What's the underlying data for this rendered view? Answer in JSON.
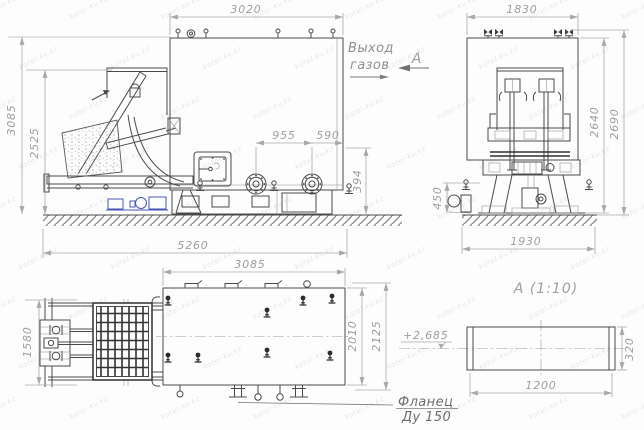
{
  "watermark": {
    "text": "kotel-kv.kz"
  },
  "colors": {
    "object_line": "#4a4a4a",
    "dim_line": "#a8a8a8",
    "dim_text": "#9e9e9e",
    "accent_blue": "#4656b8",
    "hatch": "#9a9a9a"
  },
  "side_view": {
    "dims": {
      "furnace_width": "3020",
      "overall_height": "3085",
      "loader_height": "2525",
      "flange_spacing": "955",
      "flange_to_wall": "590",
      "base_height": "394",
      "overall_length": "5260"
    },
    "gas_outlet_label_line1": "Выход",
    "gas_outlet_label_line2": "газов",
    "section_letter": "А"
  },
  "front_view": {
    "dims": {
      "body_width": "1830",
      "body_height": "2640",
      "overall_height": "2690",
      "base_height": "450",
      "base_width": "1930"
    }
  },
  "plan_view": {
    "dims": {
      "body_length": "3085",
      "loader_width": "1580",
      "body_depth": "2010",
      "overall_depth": "2125"
    }
  },
  "detail_view": {
    "title": "А  (1:10)",
    "dims": {
      "flange_length": "1200",
      "flange_height": "320"
    },
    "elevation_mark": "+2,685",
    "flange_callout_line1": "Фланец",
    "flange_callout_line2": "Ду 150"
  }
}
